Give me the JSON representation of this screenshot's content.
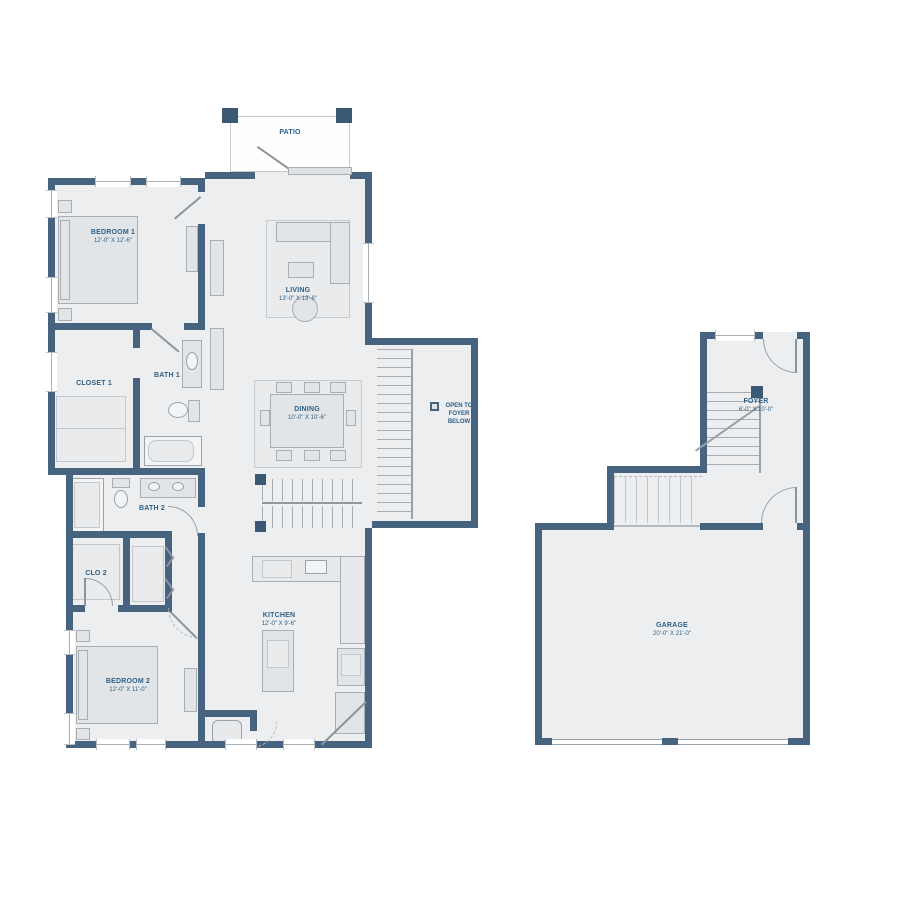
{
  "colors": {
    "wall": "#46637f",
    "post": "#3c5974",
    "floor": "#eceef0",
    "label": "#2d6088"
  },
  "plan_upper": {
    "patio": {
      "name": "PATIO"
    },
    "bedroom1": {
      "name": "BEDROOM 1",
      "dims": "12'-0\" X 12'-6\""
    },
    "living": {
      "name": "LIVING",
      "dims": "13'-0\" X 13'-6\""
    },
    "closet1": {
      "name": "CLOSET 1"
    },
    "bath1": {
      "name": "BATH 1"
    },
    "dining": {
      "name": "DINING",
      "dims": "10'-0\" X 10'-6\""
    },
    "bath2": {
      "name": "BATH 2"
    },
    "clo2": {
      "name": "CLO 2"
    },
    "bedroom2": {
      "name": "BEDROOM 2",
      "dims": "12'-0\" X 11'-0\""
    },
    "kitchen": {
      "name": "KITCHEN",
      "dims": "12'-0\" X 9'-6\""
    },
    "stair_note": "OPEN TO FOYER BELOW"
  },
  "plan_lower": {
    "foyer": {
      "name": "FOYER",
      "dims": "6'-0\" X 10'-0\""
    },
    "garage": {
      "name": "GARAGE",
      "dims": "20'-0\" X 21'-0\""
    }
  },
  "icons": {
    "stair_marker": "filled-square"
  }
}
